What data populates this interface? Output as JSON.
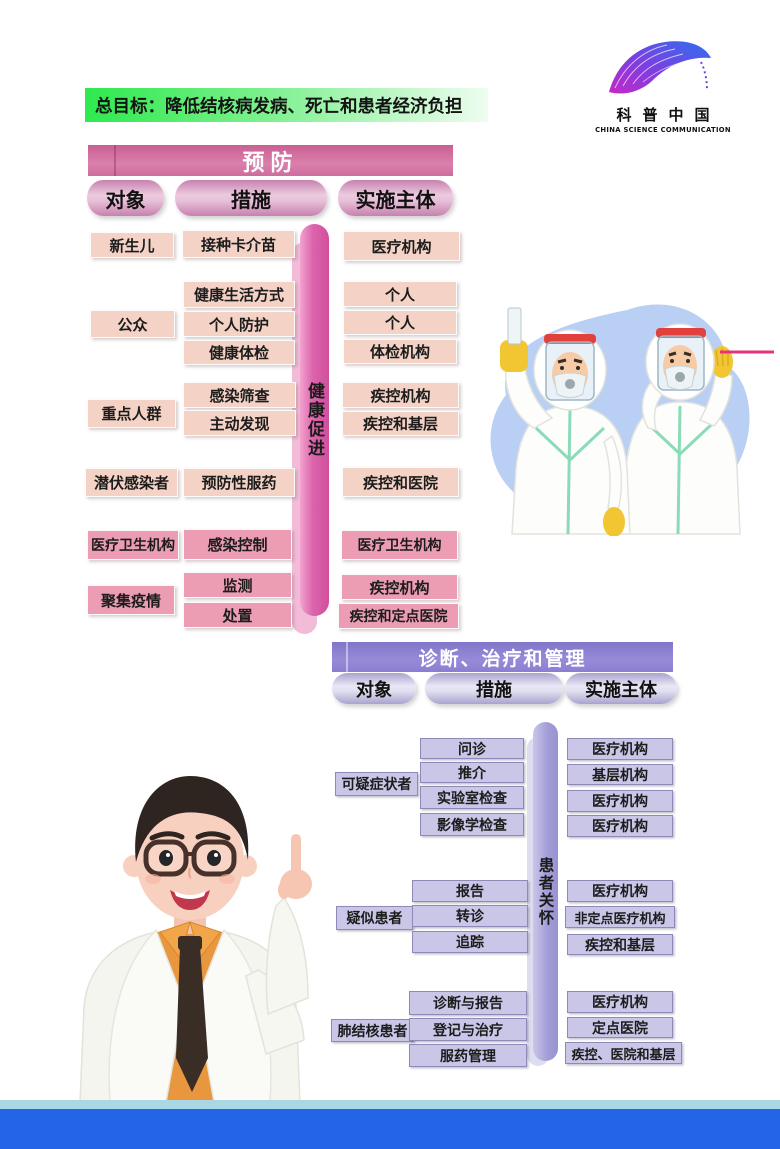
{
  "banner": {
    "text": "总目标：降低结核病发病、死亡和患者经济负担"
  },
  "logo": {
    "cn": "科普中国",
    "en": "CHINA SCIENCE COMMUNICATION"
  },
  "colors": {
    "banner_green": "#2ee94e",
    "prevention_header_pink": "#cf6d9d",
    "box_peach": "#f4d3c6",
    "box_pink": "#ec9db4",
    "diagnosis_header_purple": "#8a7ed1",
    "box_lavender": "#c9c6e7",
    "footer_blue": "#2465e8",
    "footer_light_blue": "#abd7e5"
  },
  "prevention": {
    "title": "预防",
    "columns": {
      "object": "对象",
      "measure": "措施",
      "actor": "实施主体"
    },
    "side_label": "健康促进",
    "objects": [
      "新生儿",
      "公众",
      "重点人群",
      "潜伏感染者",
      "医疗卫生机构",
      "聚集疫情"
    ],
    "measures": [
      "接种卡介苗",
      "健康生活方式",
      "个人防护",
      "健康体检",
      "感染筛查",
      "主动发现",
      "预防性服药",
      "感染控制",
      "监测",
      "处置"
    ],
    "actors": [
      "医疗机构",
      "个人",
      "个人",
      "体检机构",
      "疾控机构",
      "疾控和基层",
      "疾控和医院",
      "医疗卫生机构",
      "疾控机构",
      "疾控和定点医院"
    ]
  },
  "diagnosis": {
    "title": "诊断、治疗和管理",
    "columns": {
      "object": "对象",
      "measure": "措施",
      "actor": "实施主体"
    },
    "side_label": "患者关怀",
    "objects": [
      "可疑症状者",
      "疑似患者",
      "肺结核患者"
    ],
    "measures": [
      "问诊",
      "推介",
      "实验室检查",
      "影像学检查",
      "报告",
      "转诊",
      "追踪",
      "诊断与报告",
      "登记与治疗",
      "服药管理"
    ],
    "actors": [
      "医疗机构",
      "基层机构",
      "医疗机构",
      "医疗机构",
      "医疗机构",
      "非定点医疗机构",
      "疾控和基层",
      "医疗机构",
      "定点医院",
      "疾控、医院和基层"
    ]
  }
}
